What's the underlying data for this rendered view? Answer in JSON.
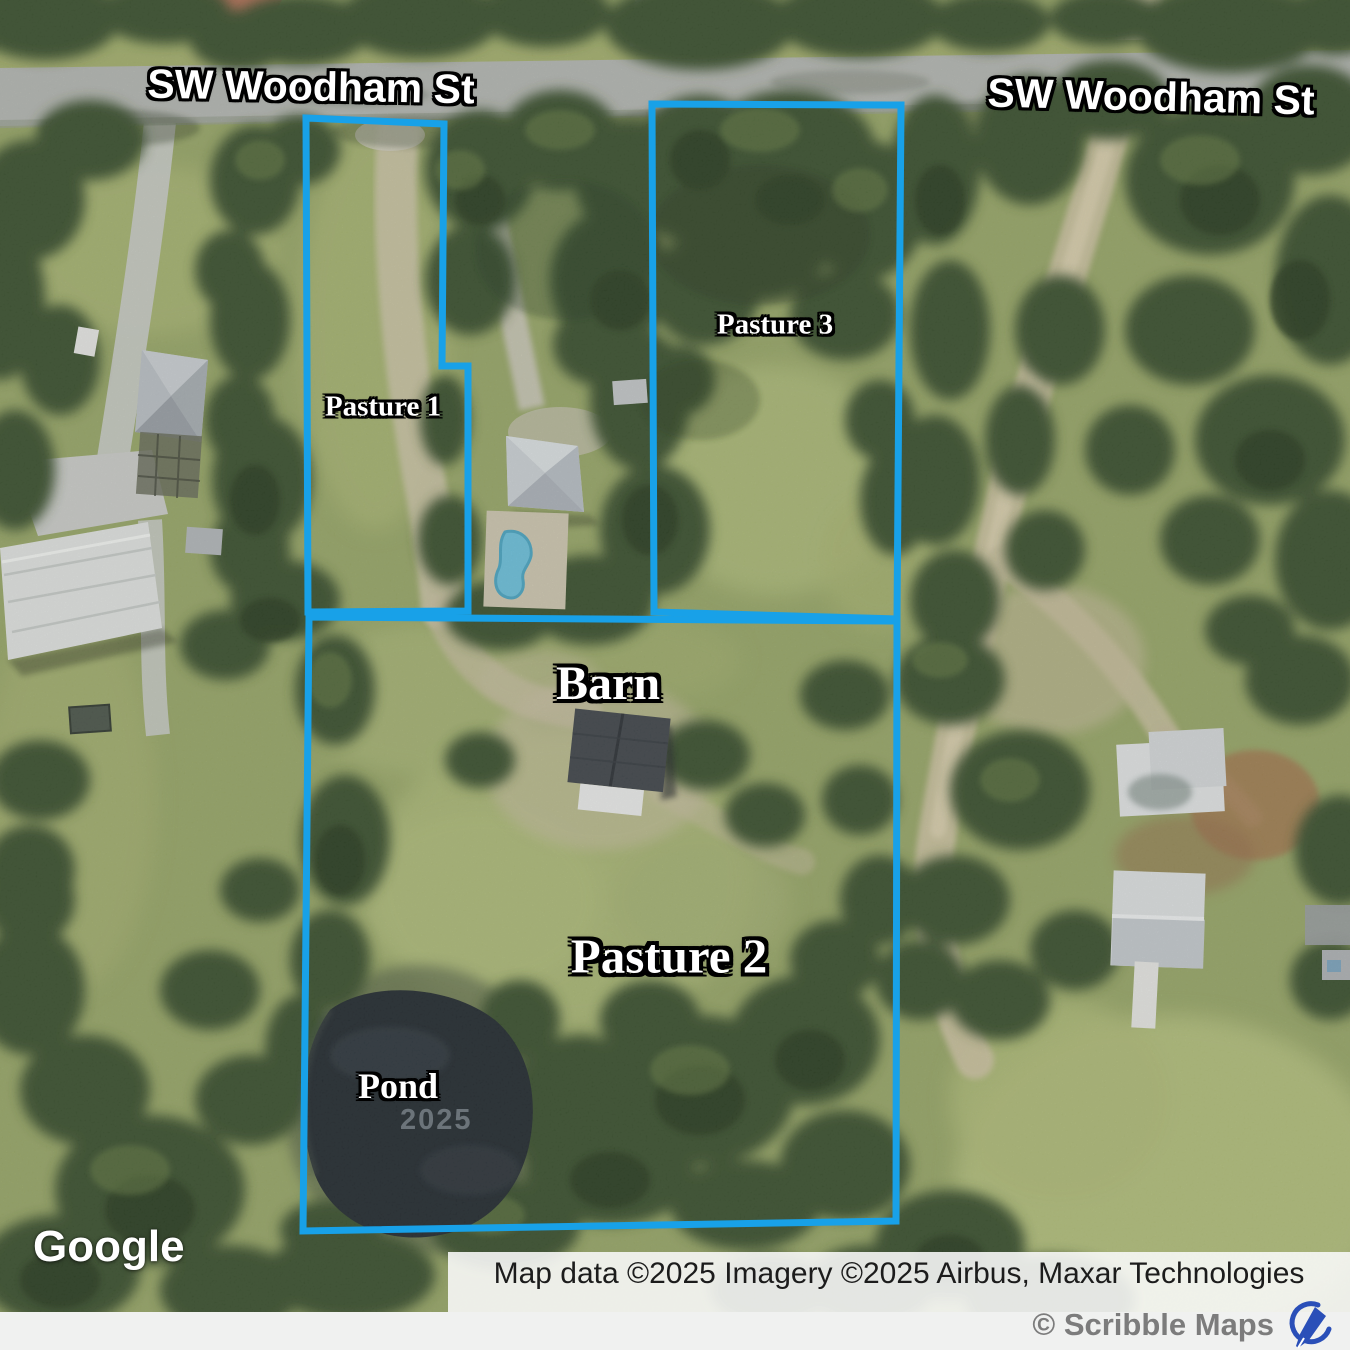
{
  "street_labels": {
    "left": "SW Woodham St",
    "right": "SW Woodham St"
  },
  "annotations": {
    "pasture1": "Pasture 1",
    "pasture3": "Pasture 3",
    "barn": "Barn",
    "pasture2": "Pasture 2",
    "pond": "Pond"
  },
  "watermark_year": "2025",
  "branding": {
    "google": "Google"
  },
  "attribution": {
    "text": "Map data ©2025 Imagery ©2025 Airbus, Maxar Technologies",
    "scribble": "© Scribble Maps"
  },
  "colors": {
    "boundary": "#18a1e8",
    "pen_icon": "#2a4fb8"
  }
}
